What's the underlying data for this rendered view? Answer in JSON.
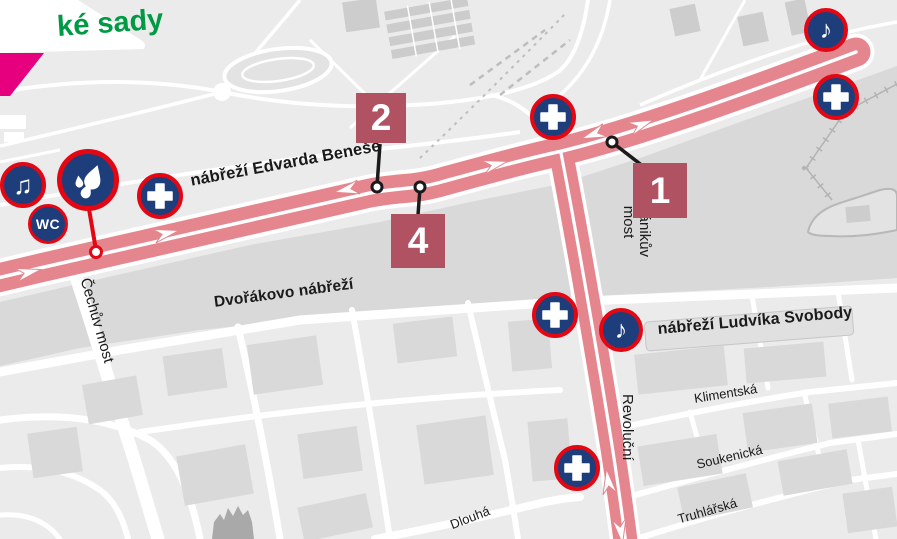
{
  "park_label": {
    "text": "ké sady"
  },
  "streets": {
    "nabrezi_edvarda_benese": "nábřeží Edvarda Beneše",
    "dvorakovo_nabrezi": "Dvořákovo nábřeží",
    "nabrezi_ludvika_svobody": "nábřeží Ludvíka Svobody",
    "cechuv_most": "Čechův most",
    "stefanikuv_most_line1": "Štefánikův",
    "stefanikuv_most_line2": "most",
    "revolucni": "Revoluční",
    "klimentska": "Klimentská",
    "soukenicka": "Soukenická",
    "truhlarska": "Truhlářská",
    "dlouha": "Dlouhá"
  },
  "markers": {
    "m1": {
      "label": "1"
    },
    "m2": {
      "label": "2"
    },
    "m4": {
      "label": "4"
    }
  },
  "icons": {
    "music_single": "♪",
    "music_double": "♫",
    "wc": "WC",
    "medical_cross": "medical-cross",
    "water_station": "water-drops"
  },
  "colors": {
    "route_pink": "#e5868f",
    "route_separator": "#ffffff",
    "km_marker_red": "#b15263",
    "icon_navy": "#1e3d7b",
    "icon_ring_red": "#e30613",
    "park_label_green": "#009a45",
    "corner_magenta": "#e6007e",
    "land_gray": "#ebebeb",
    "river_gray": "#d9d9d9",
    "building_gray": "#d6d6d6",
    "street_label_black": "#1a1a1a"
  }
}
